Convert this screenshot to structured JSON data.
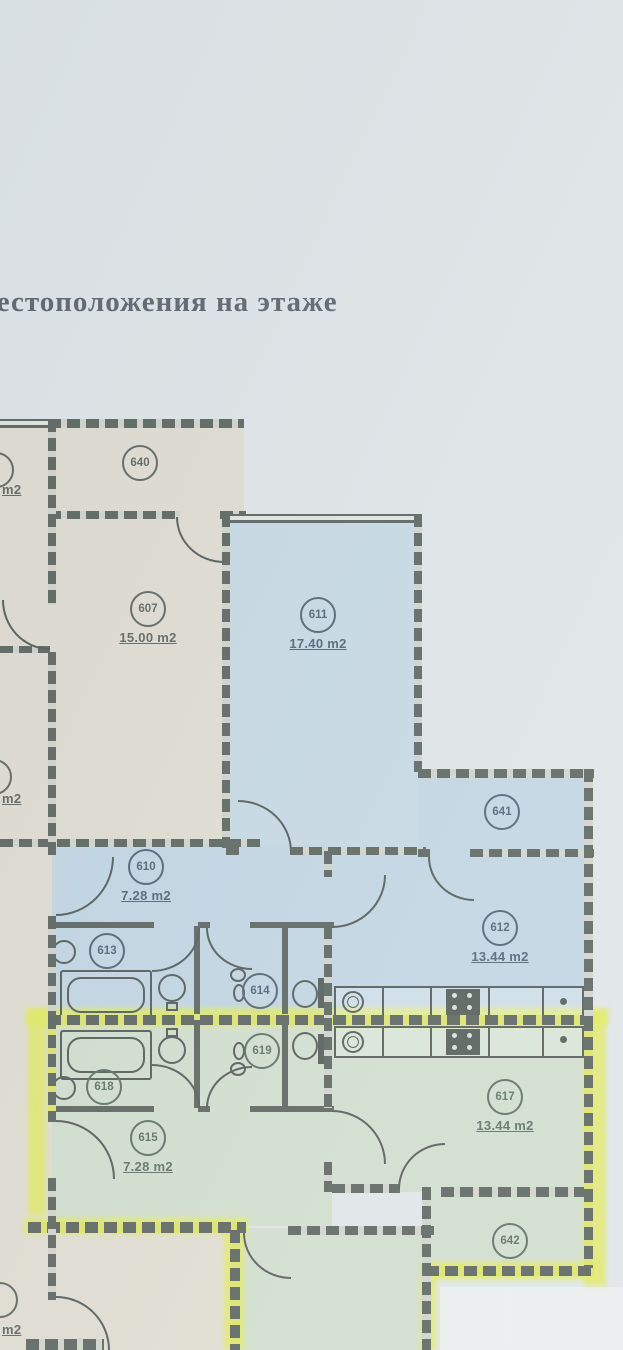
{
  "title": {
    "text": "местоположения на этаже"
  },
  "plan": {
    "rooms": [
      {
        "number": "640",
        "area": ""
      },
      {
        "number": "607",
        "area": "15.00 m2"
      },
      {
        "number": "611",
        "area": "17.40 m2"
      },
      {
        "number": "641",
        "area": ""
      },
      {
        "number": "610",
        "area": "7.28 m2"
      },
      {
        "number": "613",
        "area": ""
      },
      {
        "number": "614",
        "area": ""
      },
      {
        "number": "612",
        "area": "13.44 m2"
      },
      {
        "number": "618",
        "area": ""
      },
      {
        "number": "619",
        "area": ""
      },
      {
        "number": "615",
        "area": "7.28 m2"
      },
      {
        "number": "617",
        "area": "13.44 m2"
      },
      {
        "number": "642",
        "area": ""
      }
    ],
    "partial_labels": [
      {
        "area": "m2"
      },
      {
        "area": "m2"
      },
      {
        "area": "m2"
      }
    ],
    "colors": {
      "background": "#dce2e5",
      "room_beige": "#ddd8ca",
      "room_blue": "#b7cfdf",
      "room_green": "#cadac5",
      "highlight_yellow": "#dfe93c",
      "wall": "#3a453e"
    }
  }
}
